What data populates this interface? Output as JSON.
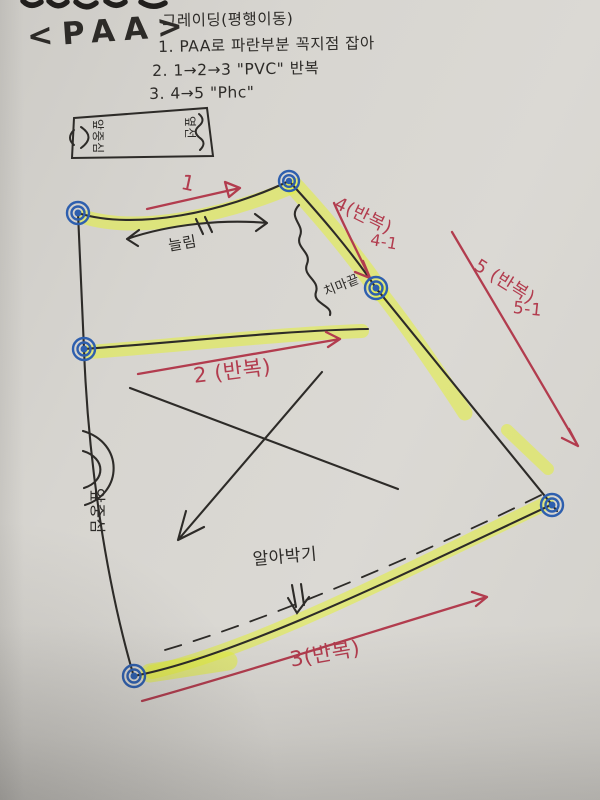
{
  "page": {
    "title": "<PAA>"
  },
  "notes": {
    "heading": "그레이딩(평행이동)",
    "items": [
      "1. PAA로 파란부분 꼭지점 잡아",
      "2. 1→2→3 \"PVC\" 반복",
      "3. 4→5 \"Phc\""
    ]
  },
  "swatch": {
    "left_label": "앞중심",
    "right_label": "옆선"
  },
  "labels": {
    "step1": "1",
    "ease": "늘림",
    "step2": "2 (반복)",
    "step3": "3(반복)",
    "step4": "4(반복)",
    "step4_sub": "4-1",
    "step5": "5 (반복)",
    "step5_sub": "5-1",
    "skirt_hem_end": "치마끝",
    "hem_finish": "알아박기",
    "front_center": "앞중심"
  },
  "colors": {
    "paper": "#d7d5d0",
    "ink": "#2d2b28",
    "marker_red": "#b23c4e",
    "highlighter": "#e4f038",
    "pen_blue": "#2e5fae"
  }
}
